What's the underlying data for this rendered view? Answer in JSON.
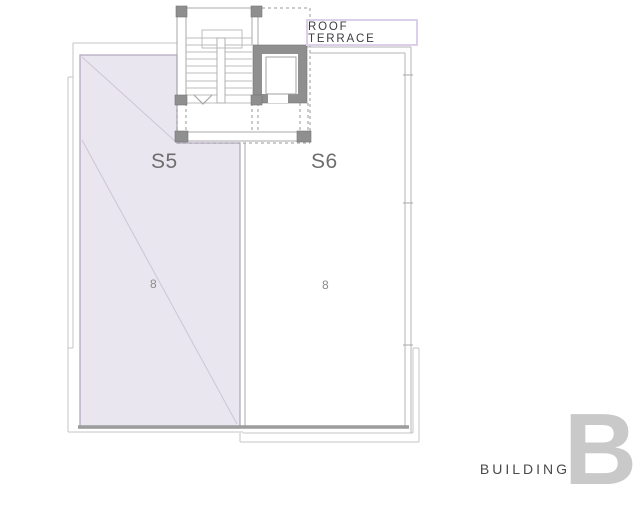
{
  "colors": {
    "s5_fill": "#e9e6ef",
    "s5_border": "#b3a9c0",
    "s5_diag": "#cdc5d8",
    "wall_dark": "#8f8f8f",
    "line": "#a8a8a8",
    "label_border": "#dccfe9",
    "text_dark": "#3c3c42",
    "text_muted": "#6e6e6e",
    "big_letter": "#c9c9c9"
  },
  "plan": {
    "terrace_label": "ROOF TERRACE",
    "units": [
      {
        "id": "S5",
        "area_value": "8"
      },
      {
        "id": "S6",
        "area_value": "8"
      }
    ]
  },
  "branding": {
    "building_word": "BUILDING",
    "building_letter": "B"
  }
}
